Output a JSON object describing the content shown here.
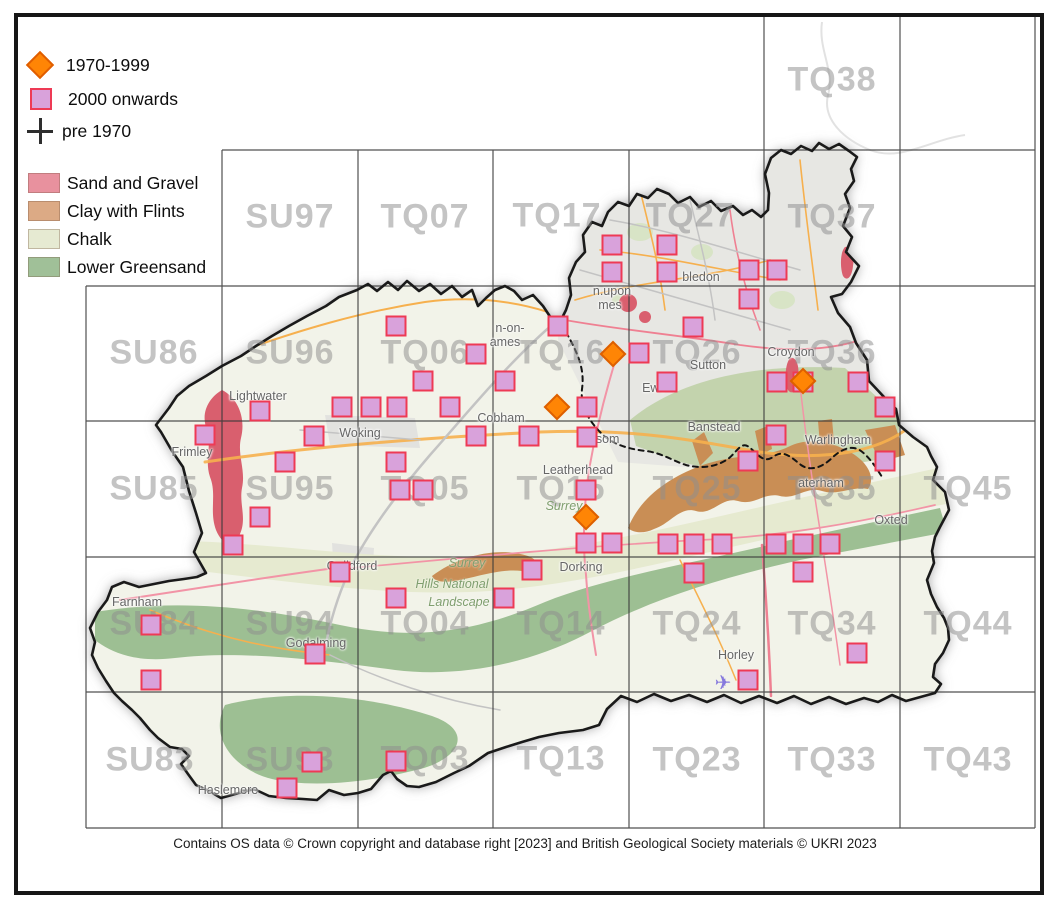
{
  "legend": {
    "periods": [
      {
        "label": "1970-1999",
        "marker": "diamond"
      },
      {
        "label": "2000 onwards",
        "marker": "square"
      },
      {
        "label": "pre 1970",
        "marker": "cross"
      }
    ],
    "geology": [
      {
        "label": "Sand and Gravel",
        "color": "#e8919e"
      },
      {
        "label": "Clay with Flints",
        "color": "#dcaa85"
      },
      {
        "label": "Chalk",
        "color": "#e6ead2"
      },
      {
        "label": "Lower Greensand",
        "color": "#a0c098"
      }
    ]
  },
  "colors": {
    "diamond_1970_1999": "#ff8505",
    "square_fill_2000_onwards": "#d9a2db",
    "square_border": "#ee3a55",
    "cross_pre_1970": "#2e2e2e",
    "sand_and_gravel": "#d95f6e",
    "clay_with_flints": "#c98e55",
    "chalk": "#e6ead0",
    "lower_greensand": "#9dbf93"
  },
  "grid_labels": [
    {
      "text": "TQ38",
      "x": 832,
      "y": 80
    },
    {
      "text": "SU97",
      "x": 290,
      "y": 217
    },
    {
      "text": "TQ07",
      "x": 425,
      "y": 217
    },
    {
      "text": "TQ17",
      "x": 557,
      "y": 216
    },
    {
      "text": "TQ27",
      "x": 690,
      "y": 216
    },
    {
      "text": "TQ37",
      "x": 832,
      "y": 217
    },
    {
      "text": "SU86",
      "x": 154,
      "y": 353
    },
    {
      "text": "SU96",
      "x": 290,
      "y": 353
    },
    {
      "text": "TQ06",
      "x": 425,
      "y": 353
    },
    {
      "text": "TQ16",
      "x": 561,
      "y": 353
    },
    {
      "text": "TQ26",
      "x": 697,
      "y": 353
    },
    {
      "text": "TQ36",
      "x": 832,
      "y": 353
    },
    {
      "text": "SU85",
      "x": 154,
      "y": 489
    },
    {
      "text": "SU95",
      "x": 290,
      "y": 489
    },
    {
      "text": "TQ05",
      "x": 425,
      "y": 489
    },
    {
      "text": "TQ15",
      "x": 561,
      "y": 489
    },
    {
      "text": "TQ25",
      "x": 697,
      "y": 489
    },
    {
      "text": "TQ35",
      "x": 832,
      "y": 489
    },
    {
      "text": "TQ45",
      "x": 968,
      "y": 489
    },
    {
      "text": "SU84",
      "x": 154,
      "y": 624
    },
    {
      "text": "SU94",
      "x": 290,
      "y": 624
    },
    {
      "text": "TQ04",
      "x": 425,
      "y": 624
    },
    {
      "text": "TQ14",
      "x": 561,
      "y": 624
    },
    {
      "text": "TQ24",
      "x": 697,
      "y": 624
    },
    {
      "text": "TQ34",
      "x": 832,
      "y": 624
    },
    {
      "text": "TQ44",
      "x": 968,
      "y": 624
    },
    {
      "text": "SU83",
      "x": 150,
      "y": 760
    },
    {
      "text": "SU93",
      "x": 290,
      "y": 760
    },
    {
      "text": "TQ03",
      "x": 425,
      "y": 759
    },
    {
      "text": "TQ13",
      "x": 561,
      "y": 759
    },
    {
      "text": "TQ23",
      "x": 697,
      "y": 760
    },
    {
      "text": "TQ33",
      "x": 832,
      "y": 760
    },
    {
      "text": "TQ43",
      "x": 968,
      "y": 760
    }
  ],
  "towns": [
    {
      "name": "Lightwater",
      "x": 258,
      "y": 396
    },
    {
      "name": "Frimley",
      "x": 192,
      "y": 452
    },
    {
      "name": "Woking",
      "x": 360,
      "y": 433
    },
    {
      "name": "Cobham",
      "x": 501,
      "y": 418
    },
    {
      "name": "Leatherhead",
      "x": 578,
      "y": 470
    },
    {
      "name": "Epsom",
      "x": 600,
      "y": 439
    },
    {
      "name": "Ewell",
      "x": 657,
      "y": 388
    },
    {
      "name": "Banstead",
      "x": 714,
      "y": 427
    },
    {
      "name": "Sutton",
      "x": 708,
      "y": 365
    },
    {
      "name": "Croydon",
      "x": 791,
      "y": 352
    },
    {
      "name": "bledon",
      "x": 701,
      "y": 277
    },
    {
      "name": "n.upon",
      "x": 612,
      "y": 291
    },
    {
      "name": "mes",
      "x": 610,
      "y": 305
    },
    {
      "name": "n-on-",
      "x": 510,
      "y": 328
    },
    {
      "name": "ames",
      "x": 505,
      "y": 342
    },
    {
      "name": "Guildford",
      "x": 352,
      "y": 566
    },
    {
      "name": "Dorking",
      "x": 581,
      "y": 567
    },
    {
      "name": "Farnham",
      "x": 137,
      "y": 602
    },
    {
      "name": "Godalming",
      "x": 316,
      "y": 643
    },
    {
      "name": "Haslemere",
      "x": 228,
      "y": 790
    },
    {
      "name": "Horley",
      "x": 736,
      "y": 655
    },
    {
      "name": "Oxted",
      "x": 891,
      "y": 520
    },
    {
      "name": "Warlingham",
      "x": 838,
      "y": 440
    },
    {
      "name": "aterham",
      "x": 821,
      "y": 483
    }
  ],
  "area_labels": [
    {
      "text": "Surrey",
      "x": 564,
      "y": 506
    },
    {
      "text": "Surrey",
      "x": 467,
      "y": 563
    },
    {
      "text": "Hills National",
      "x": 452,
      "y": 584
    },
    {
      "text": "Landscape",
      "x": 459,
      "y": 602
    }
  ],
  "markers": {
    "squares_2000_onwards": [
      [
        612,
        245
      ],
      [
        667,
        245
      ],
      [
        612,
        272
      ],
      [
        667,
        272
      ],
      [
        749,
        270
      ],
      [
        777,
        270
      ],
      [
        749,
        299
      ],
      [
        693,
        327
      ],
      [
        558,
        326
      ],
      [
        396,
        326
      ],
      [
        476,
        354
      ],
      [
        639,
        353
      ],
      [
        423,
        381
      ],
      [
        505,
        381
      ],
      [
        342,
        407
      ],
      [
        371,
        407
      ],
      [
        397,
        407
      ],
      [
        450,
        407
      ],
      [
        587,
        407
      ],
      [
        667,
        382
      ],
      [
        314,
        436
      ],
      [
        476,
        436
      ],
      [
        529,
        436
      ],
      [
        587,
        437
      ],
      [
        260,
        411
      ],
      [
        205,
        435
      ],
      [
        285,
        462
      ],
      [
        396,
        462
      ],
      [
        400,
        490
      ],
      [
        423,
        490
      ],
      [
        260,
        517
      ],
      [
        233,
        545
      ],
      [
        586,
        490
      ],
      [
        586,
        543
      ],
      [
        612,
        543
      ],
      [
        668,
        544
      ],
      [
        694,
        544
      ],
      [
        722,
        544
      ],
      [
        776,
        544
      ],
      [
        803,
        544
      ],
      [
        830,
        544
      ],
      [
        694,
        573
      ],
      [
        803,
        572
      ],
      [
        532,
        570
      ],
      [
        504,
        598
      ],
      [
        396,
        598
      ],
      [
        340,
        572
      ],
      [
        151,
        625
      ],
      [
        151,
        680
      ],
      [
        315,
        654
      ],
      [
        312,
        762
      ],
      [
        287,
        788
      ],
      [
        396,
        761
      ],
      [
        857,
        653
      ],
      [
        748,
        680
      ],
      [
        777,
        382
      ],
      [
        803,
        382
      ],
      [
        858,
        382
      ],
      [
        885,
        407
      ],
      [
        776,
        435
      ],
      [
        748,
        461
      ],
      [
        885,
        461
      ]
    ],
    "diamonds_1970_1999": [
      [
        613,
        354
      ],
      [
        557,
        407
      ],
      [
        586,
        517
      ],
      [
        803,
        381
      ]
    ],
    "crosses_pre_1970": []
  },
  "airport": {
    "glyph": "✈",
    "x": 723,
    "y": 683
  },
  "attribution": "Contains OS data  © Crown copyright and database right [2023] and British Geological Society materials © UKRI 2023"
}
